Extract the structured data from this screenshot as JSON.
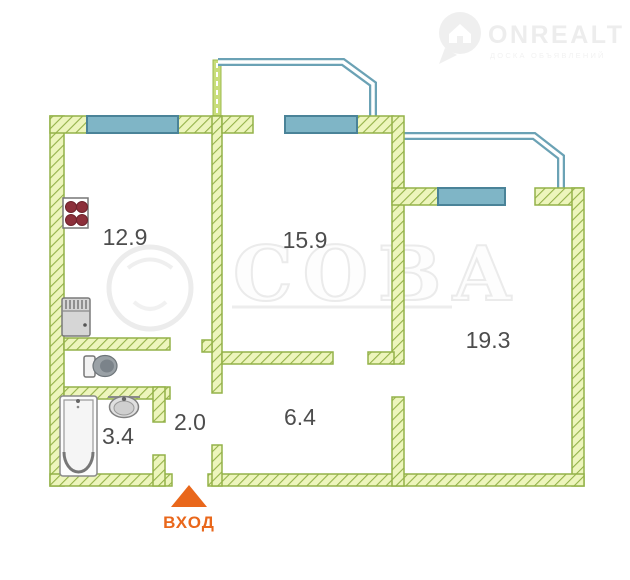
{
  "header": {
    "brand": "ONREALT",
    "tagline": "ДОСКА ОБЪЯВЛЕНИЙ",
    "icon": "location-pin-house-icon"
  },
  "watermark": {
    "text": "СОВА"
  },
  "floorplan": {
    "rooms": [
      {
        "name": "kitchen",
        "area_label": "12.9"
      },
      {
        "name": "room-1",
        "area_label": "15.9"
      },
      {
        "name": "room-2",
        "area_label": "19.3"
      },
      {
        "name": "hallway",
        "area_label": "6.4"
      },
      {
        "name": "corridor",
        "area_label": "2.0"
      },
      {
        "name": "bathroom",
        "area_label": "3.4"
      }
    ],
    "entrance_label": "ВХОД",
    "fixtures": [
      "stove-icon",
      "fridge-icon",
      "toilet-icon",
      "bathtub-icon",
      "sink-icon"
    ],
    "colors": {
      "wall_fill": "#edf5bc",
      "wall_line": "#94b249",
      "window_fill": "#7fb5c6",
      "window_border": "#4a8398",
      "balcony_line": "#6ba2b5",
      "entrance_accent": "#e9671b",
      "room_label": "#4d4d4d"
    }
  }
}
